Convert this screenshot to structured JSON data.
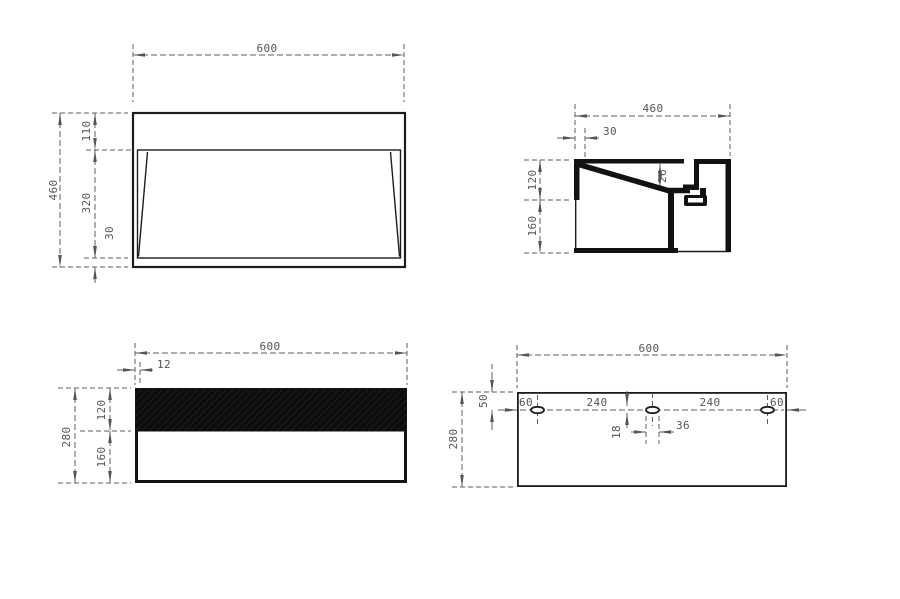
{
  "drawing": {
    "type": "technical-drawing",
    "background": "#ffffff",
    "line_color": "#1c1c1c",
    "dim_color": "#555555",
    "views": {
      "plan": {
        "dim_width": "600",
        "dim_height": "460",
        "dim_top": "110",
        "dim_middle": "320",
        "dim_bottom": "30"
      },
      "section": {
        "dim_width": "460",
        "dim_inset": "30",
        "dim_upper": "120",
        "dim_lower": "160",
        "dim_drop": "26"
      },
      "front": {
        "dim_width": "600",
        "dim_lip": "12",
        "dim_height": "280",
        "dim_upper": "120",
        "dim_lower": "160"
      },
      "back": {
        "dim_width": "600",
        "dim_height": "280",
        "dim_offset": "50",
        "dim_edge_left": "60",
        "dim_span_left": "240",
        "dim_span_right": "240",
        "dim_edge_right": "60",
        "dim_slot_h": "18",
        "dim_slot_w": "36"
      }
    }
  }
}
